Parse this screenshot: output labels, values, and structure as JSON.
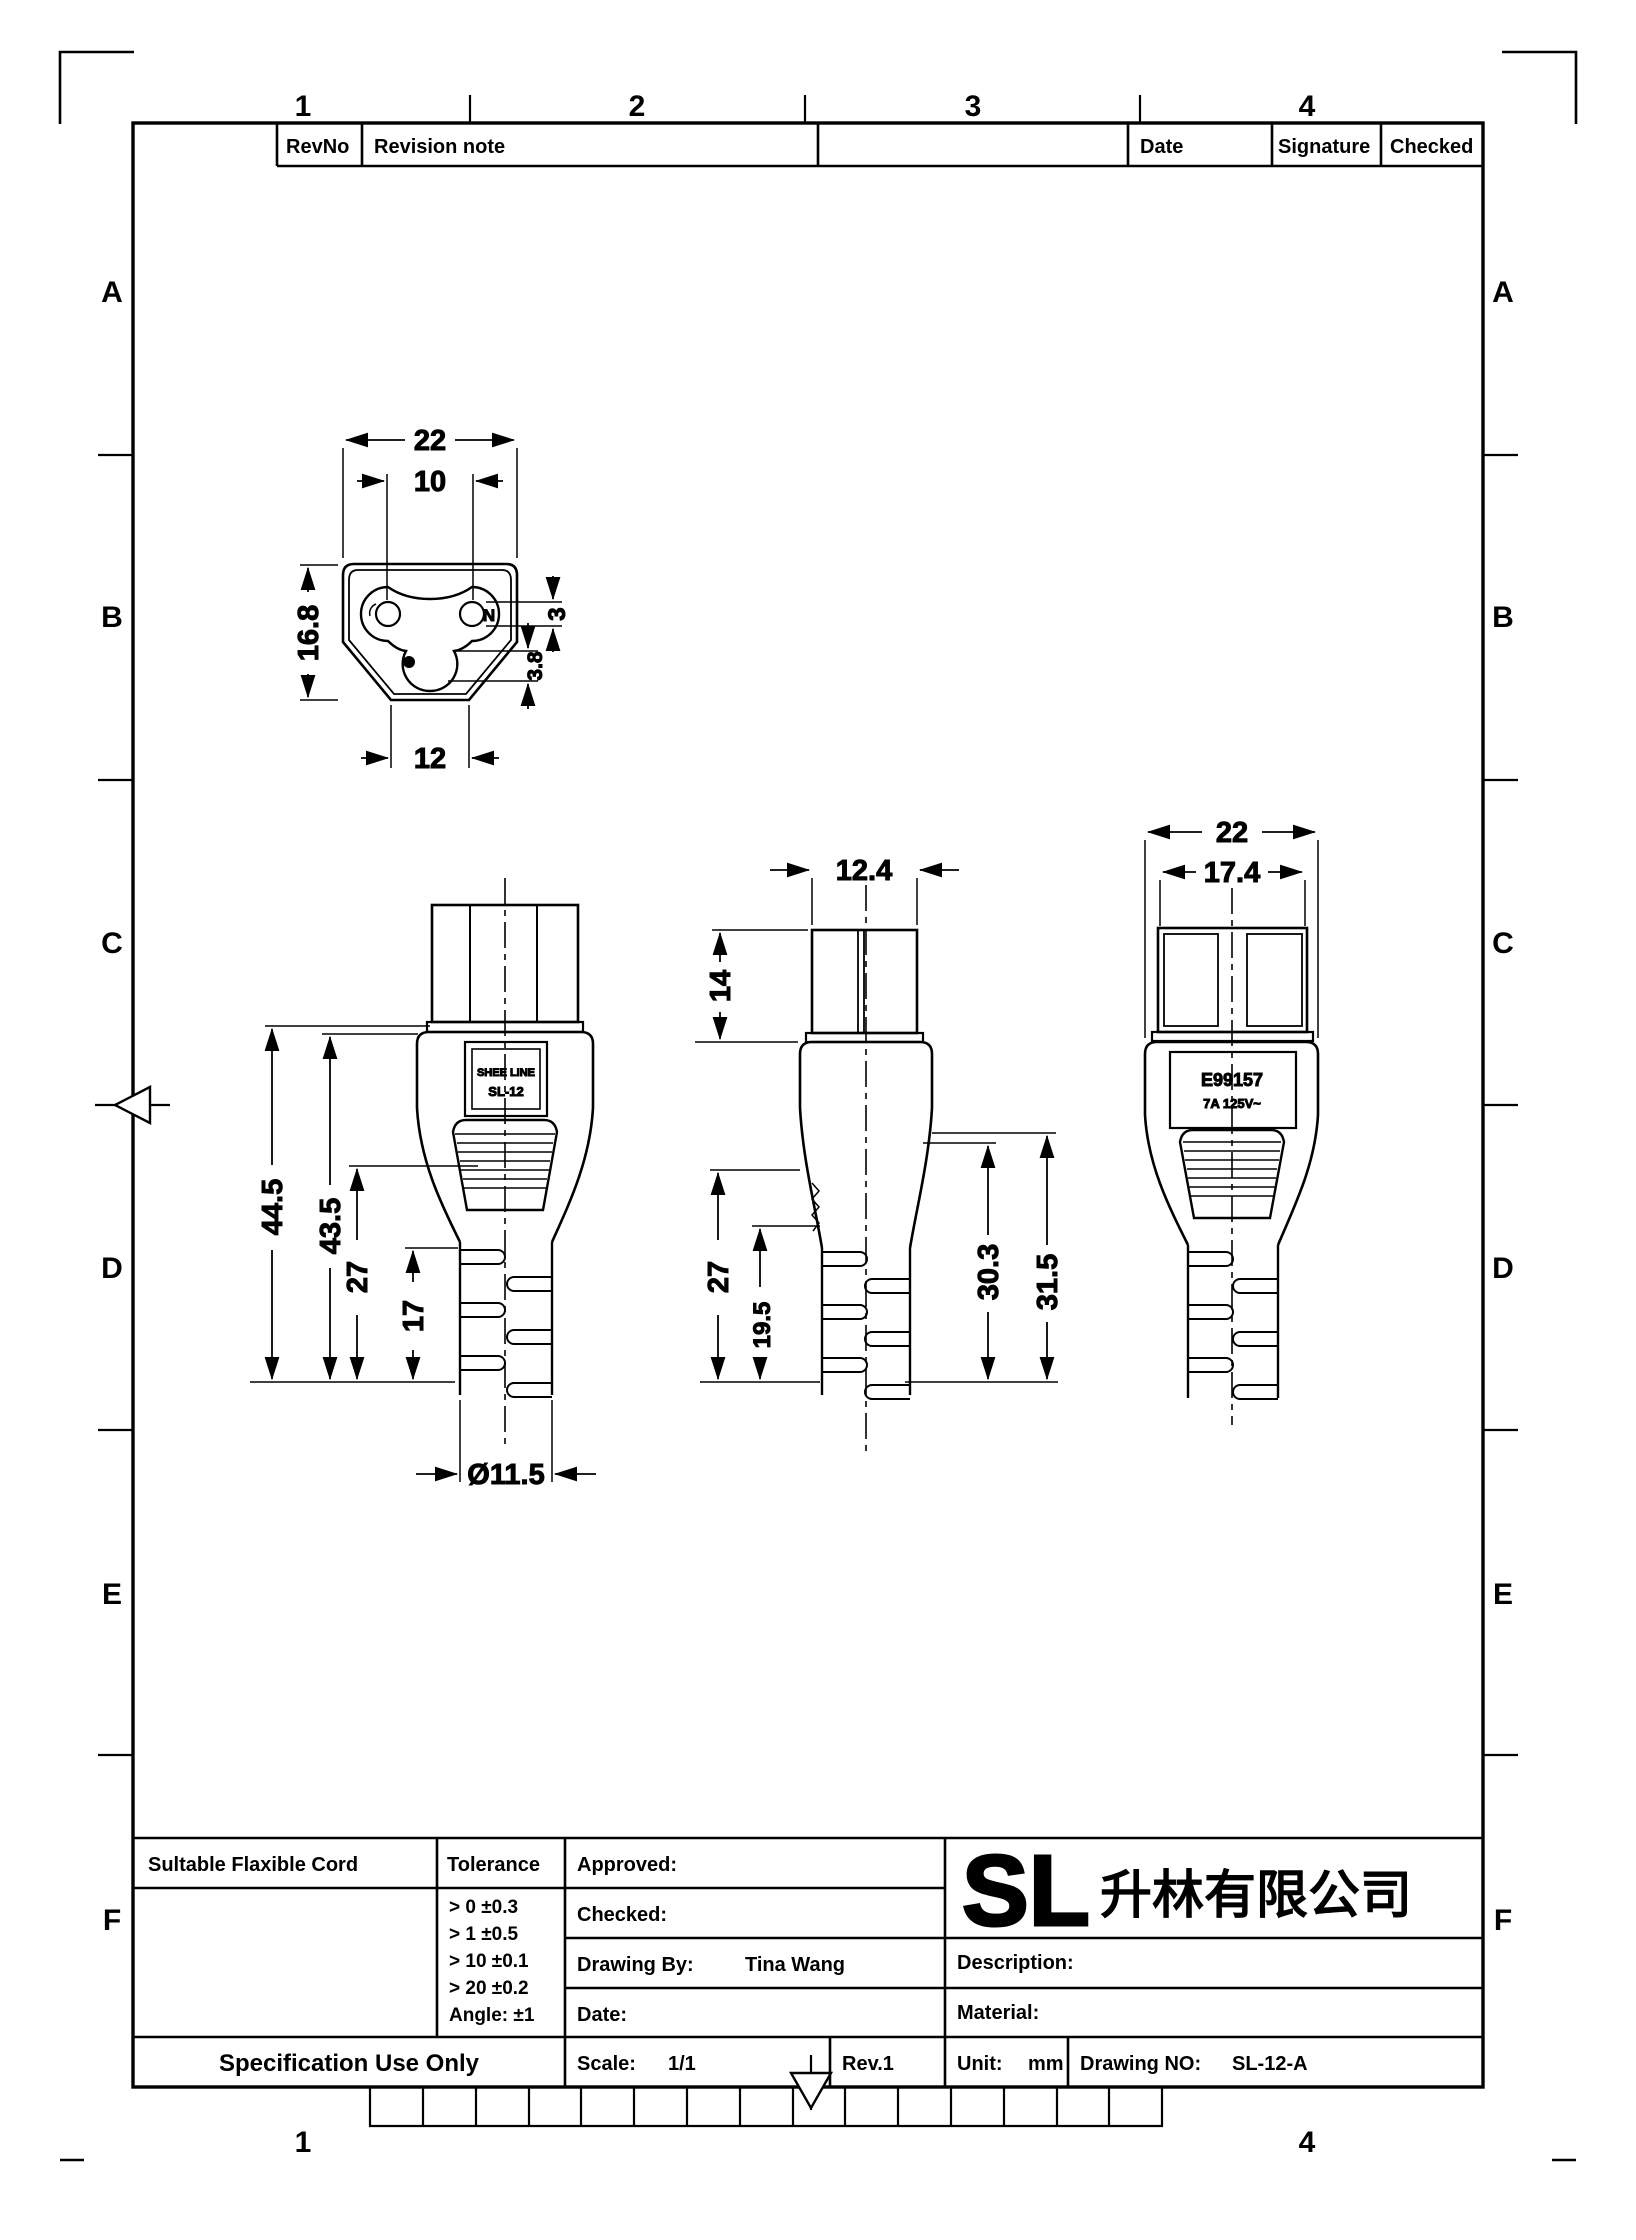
{
  "colors": {
    "line": "#000000",
    "logo_green": "#2bd12b",
    "background": "#ffffff"
  },
  "frame": {
    "top_cols": [
      "1",
      "2",
      "3",
      "4"
    ],
    "bottom_cols": [
      "1",
      "4"
    ],
    "rows": [
      "A",
      "B",
      "C",
      "D",
      "E",
      "F"
    ]
  },
  "revision_table": {
    "revno": "RevNo",
    "note": "Revision note",
    "date": "Date",
    "signature": "Signature",
    "checked": "Checked"
  },
  "top_view": {
    "dim_width": "22",
    "dim_pin_spacing": "10",
    "dim_height": "16.8",
    "dim_pin_dia": "3",
    "dim_gnd_dia": "3.8",
    "dim_bottom_width": "12",
    "neutral_label": "N"
  },
  "side_view": {
    "label_line1": "SHEE LINE",
    "label_line2": "SL-12",
    "dim_total": "44.5",
    "dim_body": "43.5",
    "dim_lower": "27",
    "dim_ribs": "17",
    "dim_cable": "Ø11.5"
  },
  "front_view": {
    "dim_top_width": "12.4",
    "dim_shroud": "14",
    "dim_lower": "27",
    "dim_ribs": "19.5",
    "dim_right_inner": "30.3",
    "dim_right_outer": "31.5"
  },
  "back_view": {
    "label_line1": "E99157",
    "label_line2": "7A 125V~",
    "dim_width": "22",
    "dim_inner": "17.4"
  },
  "title_block": {
    "suitable_cord_label": "Sultable Flaxible Cord",
    "tolerance_label": "Tolerance",
    "tolerance_rows": [
      "> 0  ±0.3",
      "> 1  ±0.5",
      "> 10  ±0.1",
      "> 20  ±0.2",
      "Angle: ±1"
    ],
    "approved_label": "Approved:",
    "checked_label": "Checked:",
    "drawing_by_label": "Drawing By:",
    "drawing_by_value": "Tina Wang",
    "date_label": "Date:",
    "logo_text": "SL",
    "company_name": "升林有限公司",
    "description_label": "Description:",
    "material_label": "Material:",
    "spec_use_only": "Specification Use Only",
    "scale_label": "Scale:",
    "scale_value": "1/1",
    "rev_value": "Rev.1",
    "unit_label": "Unit:",
    "unit_value": "mm",
    "drawing_no_label": "Drawing NO:",
    "drawing_no_value": "SL-12-A"
  }
}
